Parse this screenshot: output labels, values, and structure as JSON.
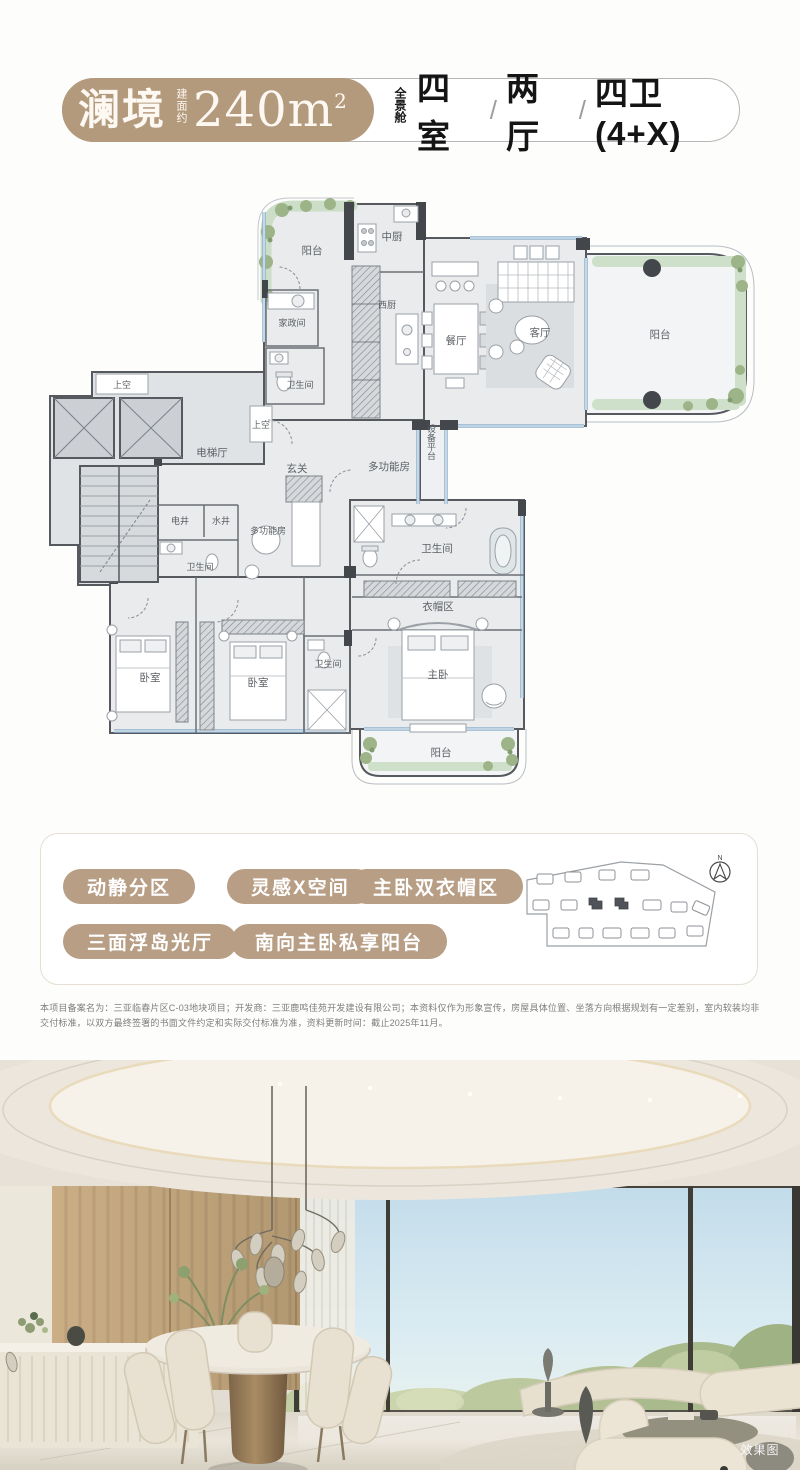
{
  "header": {
    "brand": "澜境",
    "area_label": "建面约",
    "area_value": "240m",
    "area_sup": "2",
    "capsule_tag": "全景舱",
    "spec_room": "四室",
    "spec_hall": "两厅",
    "spec_bath": "四卫(4+X)",
    "spec_separator": "/"
  },
  "floorplan": {
    "rooms": {
      "balcony_nw": "阳台",
      "kitchen_cn": "中厨",
      "laundry": "家政间",
      "bath_a": "卫生间",
      "kitchen_w": "西厨",
      "dining": "餐厅",
      "living": "客厅",
      "balcony_e": "阳台",
      "void_a": "上空",
      "void_b": "上空",
      "elevator_hall": "电梯厅",
      "foyer": "玄关",
      "multiroom_a": "多功能房",
      "equip_platform": "设备平台",
      "elec_shaft": "电井",
      "water_shaft": "水井",
      "multiroom_b": "多功能房",
      "bath_b": "卫生间",
      "bath_master": "卫生间",
      "cloak": "衣帽区",
      "bedroom_a": "卧室",
      "bedroom_b": "卧室",
      "bath_c": "卫生间",
      "master": "主卧",
      "balcony_s": "阳台"
    }
  },
  "features": {
    "tags": [
      "动静分区",
      "灵感X空间",
      "主卧双衣帽区",
      "三面浮岛光厅",
      "南向主卧私享阳台"
    ]
  },
  "siteplan": {
    "north_label": "N"
  },
  "disclaimer": "本项目备案名为：三亚临春片区C-03地块项目；开发商：三亚鹿鸣佳苑开发建设有限公司；本资料仅作为形象宣传，房屋具体位置、坐落方向根据规划有一定差别，室内软装均非交付标准，以双方最终签署的书面文件约定和实际交付标准为准，资料更新时间：截止2025年11月。",
  "photo": {
    "watermark": "效果图"
  },
  "colors": {
    "accent_tan": "#b49a7d",
    "plan_green": "#cfe0ca",
    "plan_blue": "#8fb2cf",
    "plan_wall": "#4a4e53"
  }
}
